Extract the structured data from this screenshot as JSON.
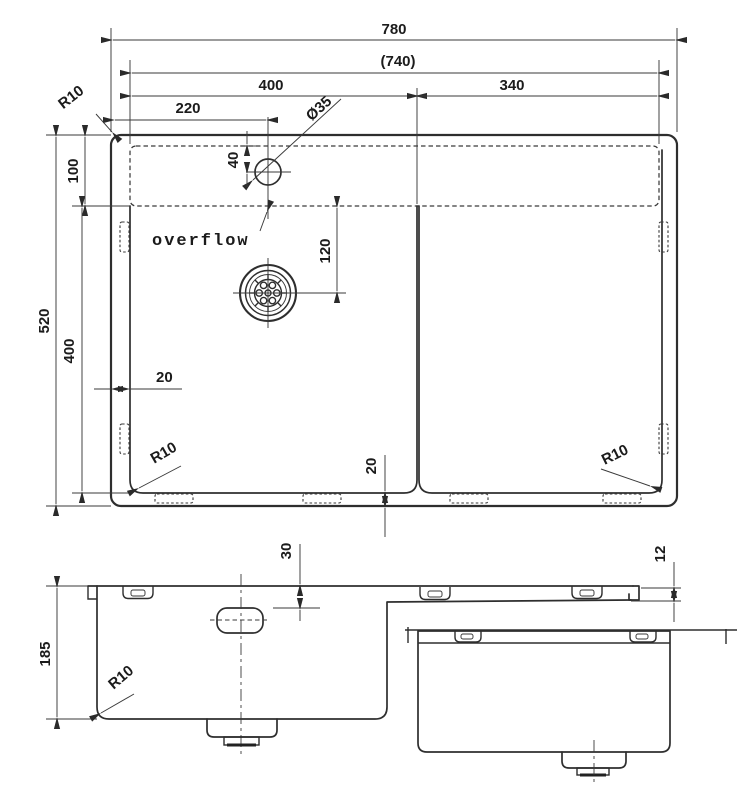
{
  "document": {
    "type": "technical-drawing",
    "subject": "kitchen sink with drainboard - dimensioned plan, front and side section views"
  },
  "colors": {
    "line": "#2e2e2e",
    "background": "#ffffff"
  },
  "top_view": {
    "dim_overall_width": "780",
    "dim_cutout_width": "(740)",
    "dim_bowl_width": "400",
    "dim_drainboard_width": "340",
    "dim_faucet_offset": "220",
    "dim_faucet_hole": "Ø35",
    "dim_faucet_to_edge": "40",
    "dim_back_ledge": "100",
    "dim_overall_depth": "520",
    "dim_bowl_depth": "400",
    "dim_drain_offset": "120",
    "dim_side_wall": "20",
    "dim_bottom_wall": "20",
    "radius_outer_corner": "R10",
    "radius_bowl_corner": "R10",
    "radius_right_corner": "R10",
    "label_overflow": "overflow"
  },
  "front_view": {
    "dim_overflow_offset": "30",
    "dim_bowl_height": "185",
    "dim_drainboard_lip": "12",
    "radius_bottom_corner": "R10"
  }
}
